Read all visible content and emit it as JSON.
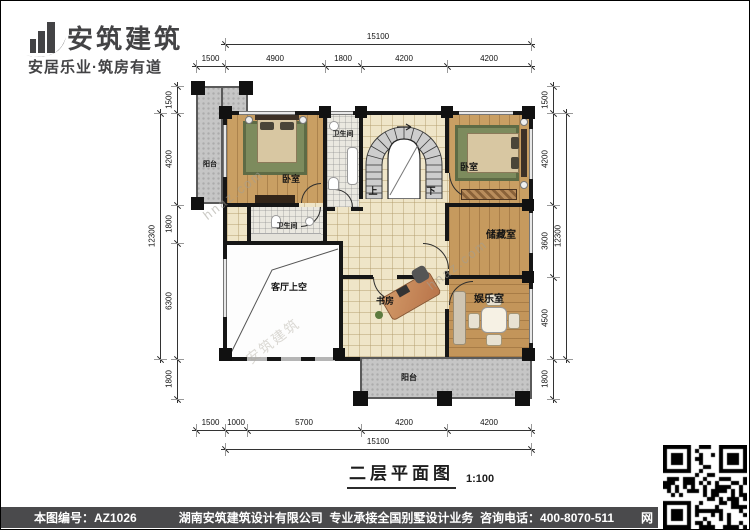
{
  "logo": {
    "company_name": "安筑建筑",
    "tagline": "安居乐业·筑房有道"
  },
  "plan": {
    "rooms": {
      "balcony_top": "阳台",
      "bedroom_left": "卧室",
      "bathroom_top": "卫生间",
      "bedroom_right": "卧室",
      "bathroom_mid": "卫生间",
      "storage": "储藏室",
      "study": "书房",
      "entertainment": "娱乐室",
      "living_void": "客厅上空",
      "balcony_bottom": "阳台"
    },
    "stair": {
      "up": "上",
      "down": "下"
    },
    "dimensions": {
      "top": {
        "overall": "15100",
        "segments": [
          "1500",
          "4900",
          "1800",
          "4200",
          "4200"
        ]
      },
      "bottom": {
        "overall": "15100",
        "segments": [
          "1500",
          "1000",
          "5700",
          "4200",
          "4200"
        ]
      },
      "left": {
        "overall": "12300",
        "segments": [
          "1500",
          "4200",
          "1800",
          "6300",
          "1800"
        ]
      },
      "right": {
        "overall": "12300",
        "segments": [
          "1500",
          "4200",
          "3600",
          "4500",
          "1800"
        ]
      }
    },
    "watermark": {
      "site": "hnaz.com",
      "brand": "安筑建筑"
    }
  },
  "title": {
    "text": "二层平面图",
    "scale": "1:100"
  },
  "footer": {
    "sheet_no": "本图编号：AZ1026",
    "company_info": "湖南安筑建筑设计有限公司  专业承接全国别墅设计业务  咨询电话：400-8070-511",
    "net_label": "网"
  },
  "colors": {
    "bar": "#4a4a4c",
    "wall": "#161616",
    "wood": "#c99f63",
    "tile": "#efe5c8",
    "balcony": "#c6c6c6",
    "rug": "#7d8b5d"
  }
}
